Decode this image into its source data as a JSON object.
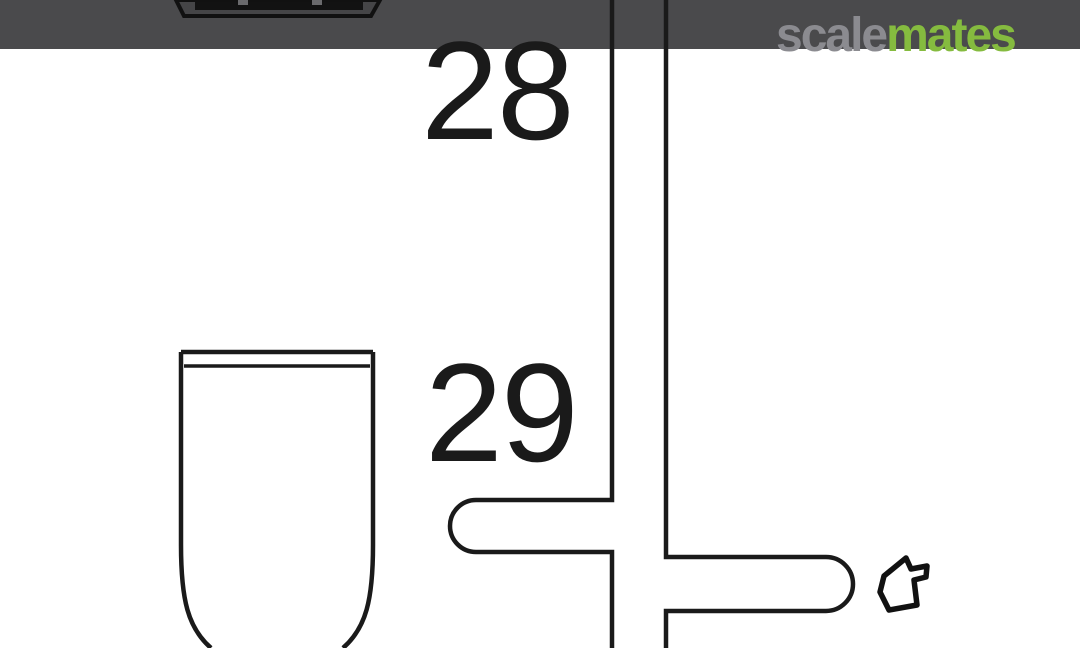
{
  "watermark": {
    "scale": "scale",
    "mates": "mates"
  },
  "callouts": {
    "top": "28",
    "bottom": "29"
  },
  "colors": {
    "top_bar": "#4a4a4c",
    "line_art": "#1a1a1a",
    "background": "#ffffff",
    "part_fill": "#454547",
    "watermark_scale": "#8b8b90",
    "watermark_mates": "#85bb3f"
  },
  "icons": {
    "part_pointer": "small-part-outline-icon"
  },
  "description": {
    "type": "model-kit-instruction-diagram",
    "visible_parts": [
      "clipped dark part silhouette at top",
      "tank/cup shaped part outline for step 29"
    ]
  }
}
